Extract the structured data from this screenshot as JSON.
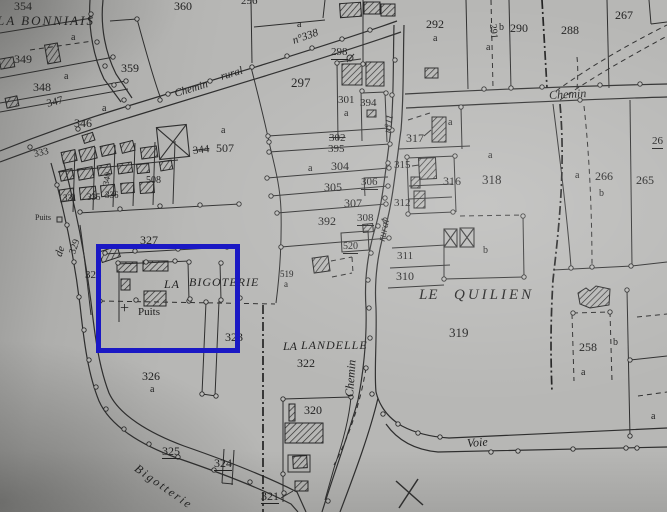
{
  "map_type": "cadastral-plan-photo",
  "colors": {
    "paper": "#b7b7b5",
    "ink": "#2e2e2e",
    "text": "#1f1f1f",
    "highlight_blue": "#1a18c4"
  },
  "highlight": {
    "x": 96,
    "y": 244,
    "width": 134,
    "height": 99,
    "border": 5
  },
  "place_names": [
    "LA BONNIAIS",
    "LA BIGOTERIE",
    "LE QUILIEN",
    "LA LANDELLE"
  ],
  "road_names": [
    "Chemin rural",
    "n°338",
    "Chemin",
    "n°11",
    "rural",
    "Chemin",
    "de",
    "Bigotterie",
    "Voie"
  ],
  "labels": [
    {
      "t": "354",
      "x": 14,
      "y": 0,
      "s": 12
    },
    {
      "t": "360",
      "x": 174,
      "y": 0,
      "s": 12
    },
    {
      "t": "LA BONNIAIS",
      "x": -3,
      "y": 14,
      "s": 13,
      "i": 1,
      "sp": 2,
      "n": "place-name"
    },
    {
      "t": "296",
      "x": 241,
      "y": -4,
      "s": 11
    },
    {
      "t": "a",
      "x": 297,
      "y": 20,
      "s": 10
    },
    {
      "t": "349",
      "x": 14,
      "y": 53,
      "s": 12
    },
    {
      "t": "a",
      "x": 71,
      "y": 33,
      "s": 10
    },
    {
      "t": "348",
      "x": 33,
      "y": 81,
      "s": 12
    },
    {
      "t": "a",
      "x": 64,
      "y": 72,
      "s": 10
    },
    {
      "t": "347",
      "x": 47,
      "y": 99,
      "s": 11,
      "r": -14
    },
    {
      "t": "346",
      "x": 74,
      "y": 117,
      "s": 12
    },
    {
      "t": "a",
      "x": 102,
      "y": 104,
      "s": 10
    },
    {
      "t": "359",
      "x": 121,
      "y": 62,
      "s": 12
    },
    {
      "t": "292",
      "x": 426,
      "y": 18,
      "s": 12
    },
    {
      "t": "a",
      "x": 433,
      "y": 34,
      "s": 10
    },
    {
      "t": "291",
      "x": 492,
      "y": 19,
      "s": 10,
      "r": 84
    },
    {
      "t": "b",
      "x": 499,
      "y": 23,
      "s": 10
    },
    {
      "t": "a",
      "x": 486,
      "y": 43,
      "s": 10
    },
    {
      "t": "290",
      "x": 510,
      "y": 22,
      "s": 12
    },
    {
      "t": "288",
      "x": 561,
      "y": 24,
      "s": 12
    },
    {
      "t": "267",
      "x": 615,
      "y": 9,
      "s": 12
    },
    {
      "t": "297",
      "x": 291,
      "y": 76,
      "s": 13
    },
    {
      "t": "298",
      "x": 331,
      "y": 47,
      "s": 11,
      "u": 1
    },
    {
      "t": "301",
      "x": 338,
      "y": 95,
      "s": 11
    },
    {
      "t": "a",
      "x": 344,
      "y": 109,
      "s": 10
    },
    {
      "t": "394",
      "x": 360,
      "y": 98,
      "s": 11
    },
    {
      "t": "302",
      "x": 329,
      "y": 133,
      "s": 11,
      "k": 1
    },
    {
      "t": "395",
      "x": 328,
      "y": 144,
      "s": 11
    },
    {
      "t": "304",
      "x": 331,
      "y": 160,
      "s": 12
    },
    {
      "t": "a",
      "x": 308,
      "y": 164,
      "s": 10
    },
    {
      "t": "305",
      "x": 324,
      "y": 181,
      "s": 12
    },
    {
      "t": "306",
      "x": 361,
      "y": 177,
      "s": 11,
      "u": 1
    },
    {
      "t": "307",
      "x": 344,
      "y": 197,
      "s": 12
    },
    {
      "t": "392",
      "x": 318,
      "y": 215,
      "s": 12
    },
    {
      "t": "308",
      "x": 357,
      "y": 213,
      "s": 11,
      "u": 1
    },
    {
      "t": "520",
      "x": 343,
      "y": 242,
      "s": 10,
      "u": 1
    },
    {
      "t": "519",
      "x": 280,
      "y": 270,
      "s": 9
    },
    {
      "t": "a",
      "x": 284,
      "y": 280,
      "s": 9
    },
    {
      "t": "344",
      "x": 193,
      "y": 146,
      "s": 11,
      "k": 1,
      "r": -7
    },
    {
      "t": "507",
      "x": 216,
      "y": 142,
      "s": 12
    },
    {
      "t": "a",
      "x": 221,
      "y": 126,
      "s": 10
    },
    {
      "t": "312",
      "x": 394,
      "y": 198,
      "s": 11
    },
    {
      "t": "311",
      "x": 397,
      "y": 251,
      "s": 11
    },
    {
      "t": "310",
      "x": 396,
      "y": 270,
      "s": 12
    },
    {
      "t": "315",
      "x": 394,
      "y": 160,
      "s": 11
    },
    {
      "t": "316",
      "x": 443,
      "y": 175,
      "s": 12
    },
    {
      "t": "317",
      "x": 406,
      "y": 132,
      "s": 12
    },
    {
      "t": "a",
      "x": 448,
      "y": 118,
      "s": 10
    },
    {
      "t": "318",
      "x": 482,
      "y": 173,
      "s": 13
    },
    {
      "t": "a",
      "x": 488,
      "y": 151,
      "s": 10
    },
    {
      "t": "b",
      "x": 483,
      "y": 246,
      "s": 10
    },
    {
      "t": "319",
      "x": 449,
      "y": 326,
      "s": 13
    },
    {
      "t": "266",
      "x": 595,
      "y": 170,
      "s": 12
    },
    {
      "t": "a",
      "x": 575,
      "y": 171,
      "s": 10
    },
    {
      "t": "b",
      "x": 599,
      "y": 189,
      "s": 10
    },
    {
      "t": "265",
      "x": 636,
      "y": 174,
      "s": 12
    },
    {
      "t": "26",
      "x": 652,
      "y": 136,
      "s": 11,
      "u": 1
    },
    {
      "t": "258",
      "x": 579,
      "y": 341,
      "s": 12
    },
    {
      "t": "b",
      "x": 613,
      "y": 338,
      "s": 10
    },
    {
      "t": "a",
      "x": 581,
      "y": 368,
      "s": 10
    },
    {
      "t": "a",
      "x": 651,
      "y": 412,
      "s": 10
    },
    {
      "t": "327",
      "x": 140,
      "y": 234,
      "s": 12
    },
    {
      "t": "328",
      "x": 85,
      "y": 270,
      "s": 11
    },
    {
      "t": "329",
      "x": 73,
      "y": 249,
      "s": 10,
      "r": -72
    },
    {
      "t": "333",
      "x": 34,
      "y": 150,
      "s": 10,
      "r": -13
    },
    {
      "t": "340",
      "x": 106,
      "y": 181,
      "s": 9,
      "r": -80
    },
    {
      "t": "508",
      "x": 146,
      "y": 176,
      "s": 10
    },
    {
      "t": "331",
      "x": 63,
      "y": 194,
      "s": 9
    },
    {
      "t": "335",
      "x": 87,
      "y": 193,
      "s": 9
    },
    {
      "t": "336",
      "x": 105,
      "y": 191,
      "s": 9
    },
    {
      "t": "Puits",
      "x": 35,
      "y": 214,
      "s": 8,
      "n": "well-label"
    },
    {
      "t": "LA",
      "x": 164,
      "y": 278,
      "s": 12,
      "i": 1,
      "sp": 1,
      "n": "place-name"
    },
    {
      "t": "BIGOTERIE",
      "x": 189,
      "y": 276,
      "s": 12,
      "i": 1,
      "sp": 1,
      "n": "place-name"
    },
    {
      "t": "+",
      "x": 120,
      "y": 301,
      "s": 16,
      "n": "well-cross"
    },
    {
      "t": "Puits",
      "x": 138,
      "y": 307,
      "s": 11,
      "n": "well-label"
    },
    {
      "t": "323",
      "x": 225,
      "y": 331,
      "s": 12
    },
    {
      "t": "LE",
      "x": 419,
      "y": 288,
      "s": 15,
      "i": 1,
      "sp": 1,
      "n": "place-name"
    },
    {
      "t": "QUILIEN",
      "x": 454,
      "y": 288,
      "s": 15,
      "i": 1,
      "sp": 3,
      "n": "place-name"
    },
    {
      "t": "LA",
      "x": 283,
      "y": 340,
      "s": 12,
      "i": 1,
      "n": "place-name"
    },
    {
      "t": "LANDELLE",
      "x": 301,
      "y": 339,
      "s": 12,
      "i": 1,
      "sp": 1,
      "n": "place-name"
    },
    {
      "t": "322",
      "x": 297,
      "y": 357,
      "s": 12
    },
    {
      "t": "326",
      "x": 142,
      "y": 370,
      "s": 12
    },
    {
      "t": "a",
      "x": 150,
      "y": 385,
      "s": 10
    },
    {
      "t": "325",
      "x": 162,
      "y": 445,
      "s": 12,
      "u": 1
    },
    {
      "t": "324",
      "x": 214,
      "y": 457,
      "s": 12,
      "u": 1
    },
    {
      "t": "320",
      "x": 304,
      "y": 404,
      "s": 12
    },
    {
      "t": "321",
      "x": 261,
      "y": 490,
      "s": 12,
      "u": 1
    },
    {
      "t": "Chemin",
      "x": 175,
      "y": 89,
      "s": 11,
      "i": 1,
      "r": -17,
      "n": "road-name"
    },
    {
      "t": "rural",
      "x": 221,
      "y": 72,
      "s": 11,
      "i": 1,
      "r": -17,
      "n": "road-name"
    },
    {
      "t": "n°338",
      "x": 293,
      "y": 36,
      "s": 11,
      "i": 1,
      "r": -19,
      "n": "road-name"
    },
    {
      "t": "Chemin",
      "x": 549,
      "y": 89,
      "s": 12,
      "i": 1,
      "r": -3,
      "n": "road-name"
    },
    {
      "t": "n°11",
      "x": 388,
      "y": 128,
      "s": 10,
      "i": 1,
      "r": -80,
      "n": "road-name"
    },
    {
      "t": "rural",
      "x": 382,
      "y": 236,
      "s": 11,
      "i": 1,
      "r": -78,
      "n": "road-name"
    },
    {
      "t": "Chemin",
      "x": 349,
      "y": 391,
      "s": 12,
      "i": 1,
      "r": -86,
      "n": "road-name"
    },
    {
      "t": "de",
      "x": 59,
      "y": 251,
      "s": 11,
      "i": 1,
      "r": -72,
      "n": "road-name"
    },
    {
      "t": "Bigotterie",
      "x": 136,
      "y": 461,
      "s": 12,
      "i": 1,
      "r": 35,
      "sp": 2,
      "n": "road-name"
    },
    {
      "t": "Voie",
      "x": 467,
      "y": 437,
      "s": 12,
      "i": 1,
      "r": -4,
      "n": "road-name"
    }
  ]
}
